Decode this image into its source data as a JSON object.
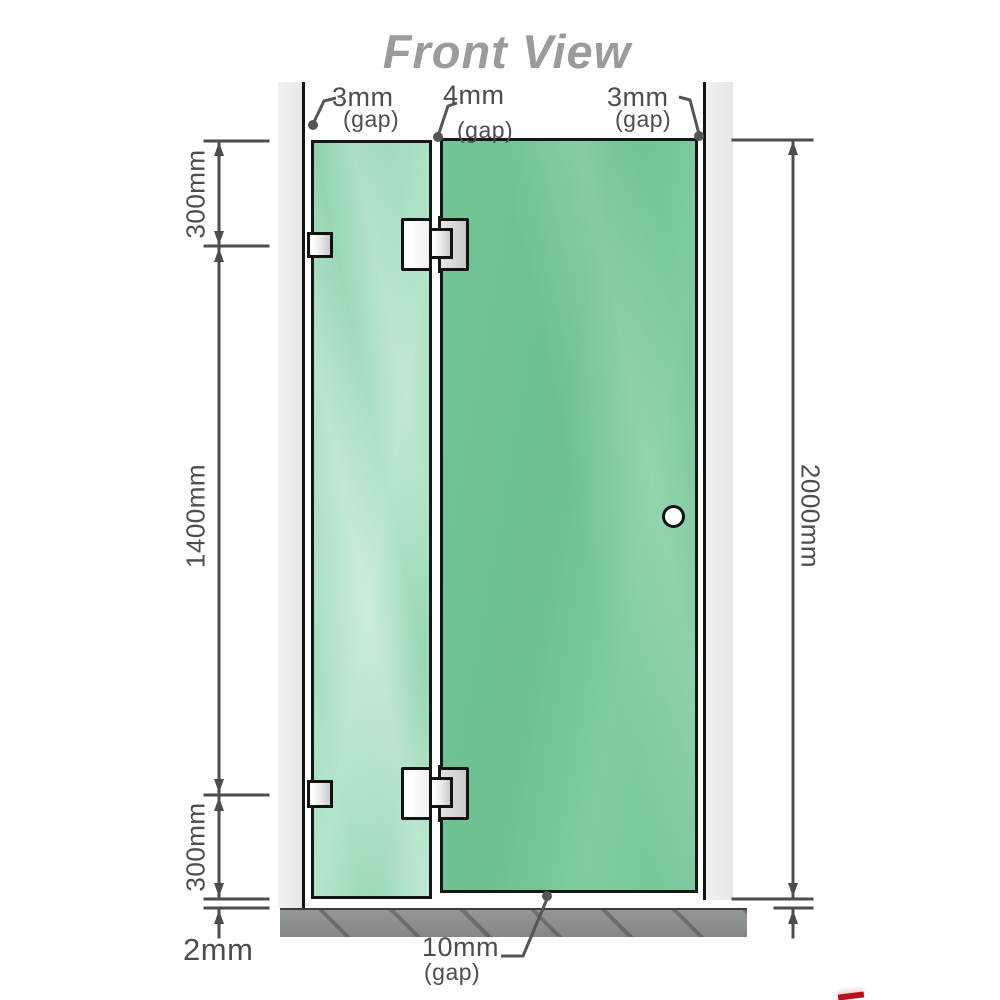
{
  "title": "Front View",
  "measurements": {
    "segment_top": "300mm",
    "segment_middle": "1400mm",
    "segment_bottom": "300mm",
    "total_height": "2000mm",
    "floor_clearance": "2mm",
    "gap_wall_left": {
      "value": "3mm",
      "note": "(gap)"
    },
    "gap_panel_door": {
      "value": "4mm",
      "note": "(gap)"
    },
    "gap_wall_right": {
      "value": "3mm",
      "note": "(gap)"
    },
    "gap_door_floor": {
      "value": "10mm",
      "note": "(gap)"
    }
  },
  "colors": {
    "glass_door": "#70c394",
    "glass_fixed_panel": "#a9dfc1",
    "wall": "#ececec",
    "floor": "#8c908c",
    "outline": "#161616",
    "dimension_lines": "#4d4d4d",
    "title_text": "#9b9b9b",
    "corner_mark": "#b5121b"
  },
  "components": {
    "left_wall": "wall",
    "right_wall": "wall",
    "fixed_glass_panel": "fixed panel",
    "glass_door": "hinged door",
    "hinges": 2,
    "wall_brackets": 2,
    "handle": "round knob",
    "floor": "hatched floor strip"
  }
}
